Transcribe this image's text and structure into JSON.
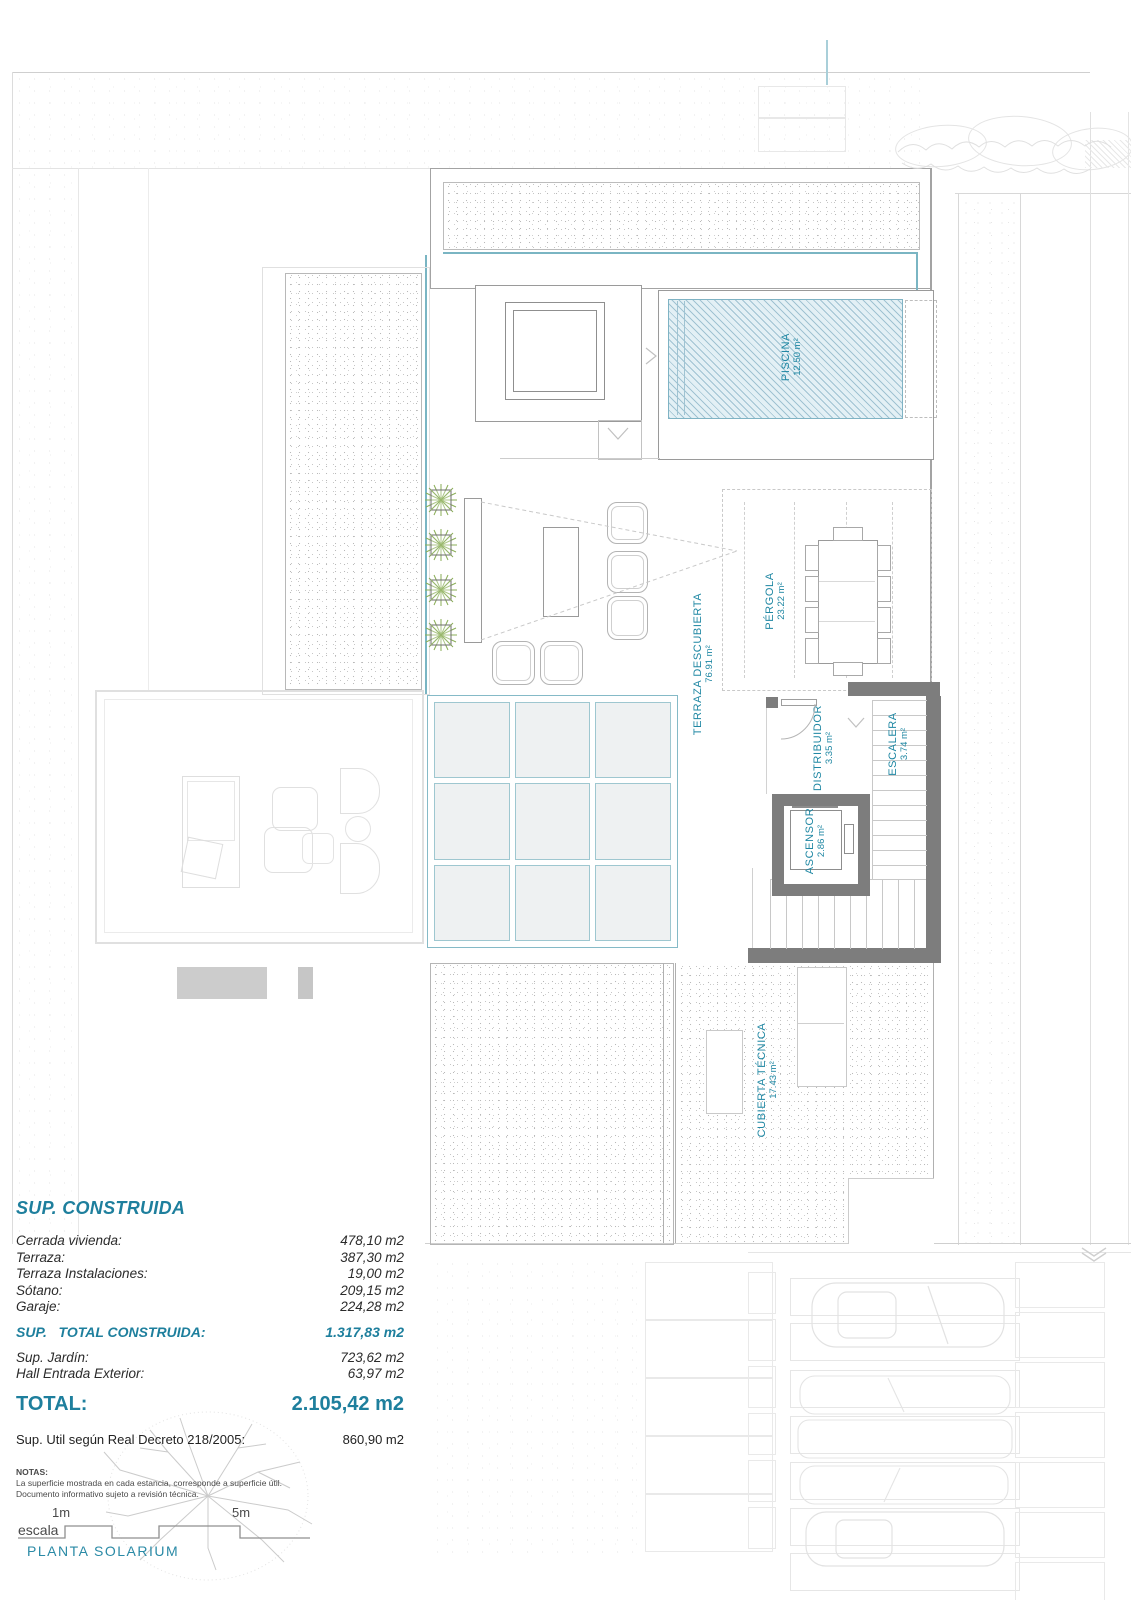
{
  "colors": {
    "accent_teal": "#1e7f9d",
    "plan_label_teal": "#1f87a3",
    "terrace_line_teal": "#7ab5c3",
    "wall_gray": "#7d7d7d",
    "pool_fill": "#e3f0f5",
    "pool_hatch": "#7fb3c4"
  },
  "plan": {
    "title": "PLANTA SOLARIUM",
    "scale_label": "escala",
    "scale_1m": "1m",
    "scale_5m": "5m",
    "rooms": {
      "piscina": {
        "name": "PISCINA",
        "area": "12.50 m²"
      },
      "pergola": {
        "name": "PÉRGOLA",
        "area": "23.22 m²"
      },
      "terraza": {
        "name": "TERRAZA DESCUBIERTA",
        "area": "76.91 m²"
      },
      "distribuidor": {
        "name": "DISTRIBUIDOR",
        "area": "3.35 m²"
      },
      "escalera": {
        "name": "ESCALERA",
        "area": "3.74 m²"
      },
      "ascensor": {
        "name": "ASCENSOR",
        "area": "2.86 m²"
      },
      "cubierta": {
        "name": "CUBIERTA TÉCNICA",
        "area": "17.43 m²"
      }
    }
  },
  "areas": {
    "title": "SUP. CONSTRUIDA",
    "rows": [
      {
        "label": "Cerrada vivienda:",
        "value": "478,10 m2"
      },
      {
        "label": "Terraza:",
        "value": "387,30 m2"
      },
      {
        "label": "Terraza Instalaciones:",
        "value": "19,00 m2"
      },
      {
        "label": "Sótano:",
        "value": "209,15 m2"
      },
      {
        "label": "Garaje:",
        "value": "224,28 m2"
      }
    ],
    "total_construida": {
      "label": "SUP.   TOTAL CONSTRUIDA:",
      "value": "1.317,83 m2"
    },
    "extra_rows": [
      {
        "label": "Sup. Jardín:",
        "value": "723,62 m2"
      },
      {
        "label": "Hall Entrada Exterior:",
        "value": "63,97 m2"
      }
    ],
    "grand_total": {
      "label": "TOTAL:",
      "value": "2.105,42 m2"
    },
    "util": {
      "label": "Sup. Util según Real Decreto 218/2005:",
      "value": "860,90 m2"
    },
    "notes": {
      "title": "NOTAS:",
      "lines": [
        "La superficie mostrada en cada estancia, corresponde a superficie útil.",
        "Documento informativo sujeto a revisión técnica."
      ]
    }
  }
}
